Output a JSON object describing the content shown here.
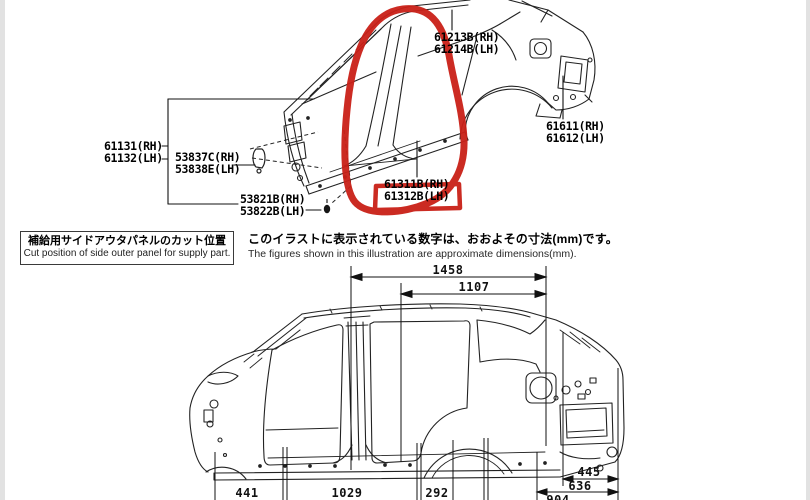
{
  "page": {
    "background": "#ffffff",
    "edge_color": "#e2e2e2",
    "annotation_color": "#c92017",
    "line_color": "#222222"
  },
  "upper_diagram": {
    "labels": {
      "l61213": {
        "line1": "61213B(RH)",
        "line2": "61214B(LH)"
      },
      "l61611": {
        "line1": "61611(RH)",
        "line2": "61612(LH)"
      },
      "l61131": {
        "line1": "61131(RH)",
        "line2": "61132(LH)"
      },
      "l53837": {
        "line1": "53837C(RH)",
        "line2": "53838E(LH)"
      },
      "l53821": {
        "line1": "53821B(RH)",
        "line2": "53822B(LH)"
      },
      "l61311": {
        "line1": "61311B(RH)",
        "line2": "61312B(LH)"
      }
    }
  },
  "notes": {
    "cut_box_jp": "補給用サイドアウタパネルのカット位置",
    "cut_box_en": "Cut position of side outer panel for supply part.",
    "dims_jp": "このイラストに表示されている数字は、おおよその寸法(mm)です。",
    "dims_en": "The figures shown in this illustration are approximate dimensions(mm)."
  },
  "lower_diagram": {
    "dims": {
      "top1": "1458",
      "top2": "1107",
      "bottom1": "441",
      "bottom2": "1029",
      "bottom3": "292",
      "bottom4": "904",
      "right1": "445",
      "right2": "636"
    }
  }
}
